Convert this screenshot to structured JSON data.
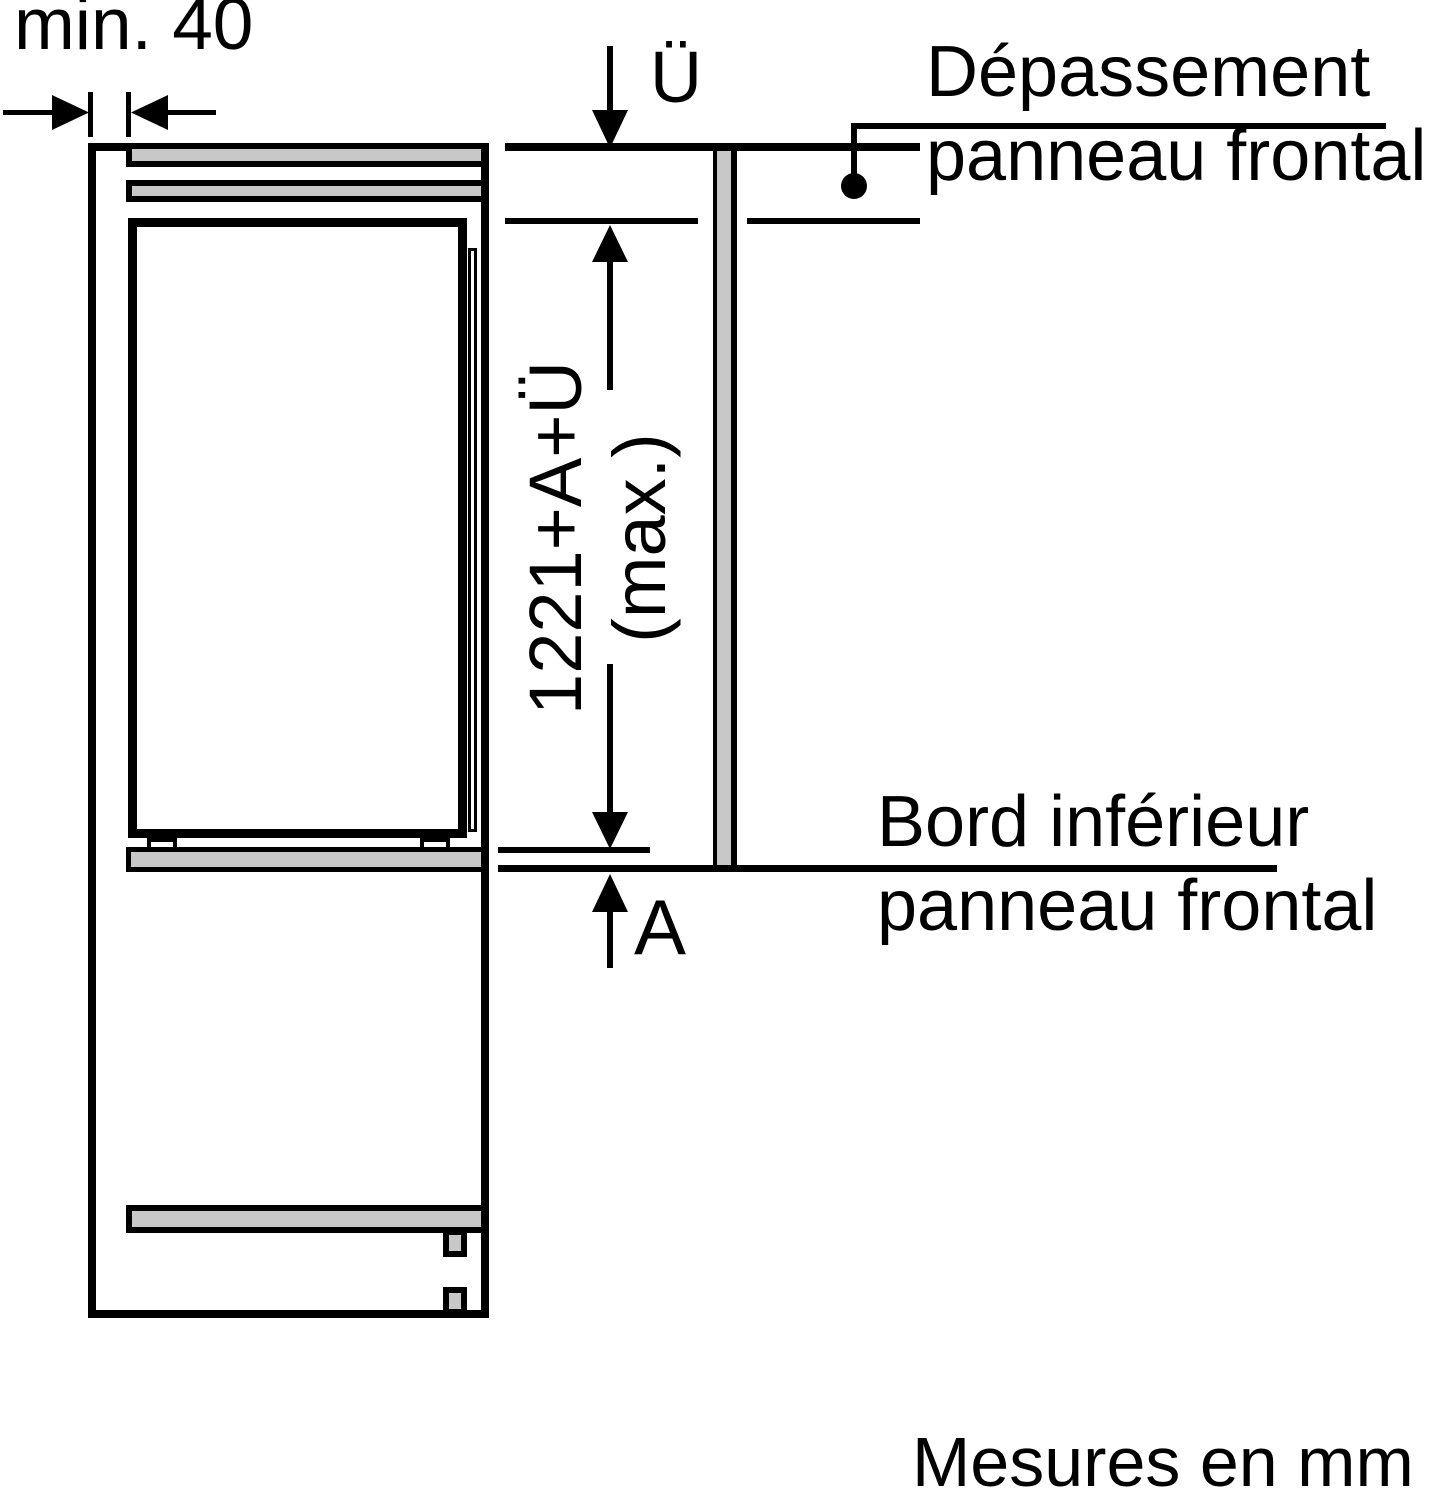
{
  "texts": {
    "min_gap": "min. 40",
    "overhang_symbol": "Ü",
    "panel_max_line1": "1221+A+Ü",
    "panel_max_line2": "(max.)",
    "gap_below_symbol": "A",
    "overhang_label_line1": "Dépassement",
    "overhang_label_line2": "panneau frontal",
    "bottom_edge_label_line1": "Bord inférieur",
    "bottom_edge_label_line2": "panneau frontal",
    "units_note": "Mesures en mm"
  },
  "colors": {
    "line": "#000000",
    "panel_fill": "#c8c8c8",
    "background": "#ffffff"
  }
}
